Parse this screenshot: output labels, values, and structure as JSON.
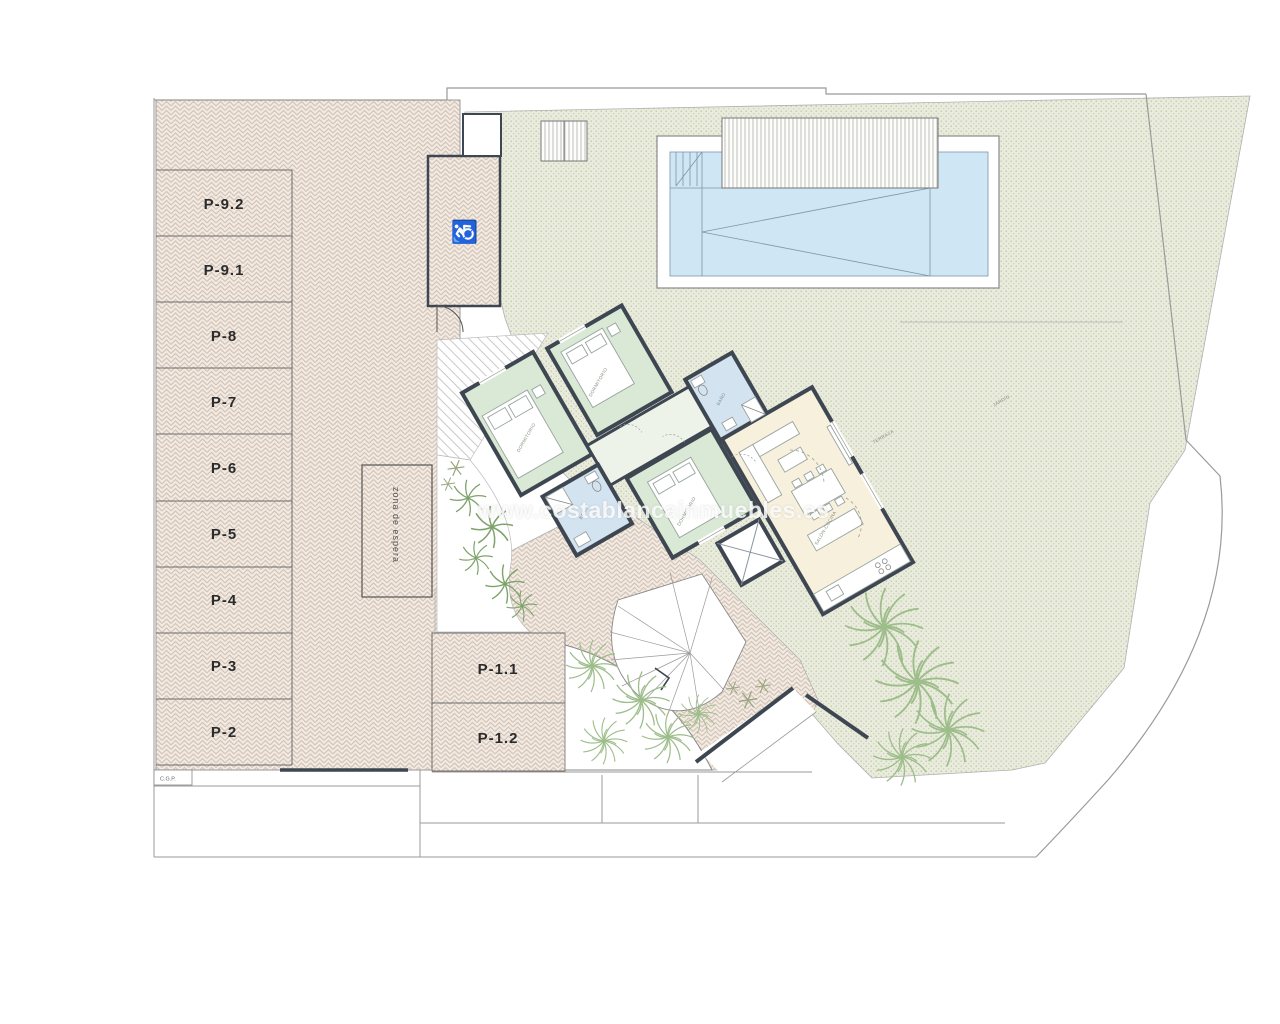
{
  "watermark": "www.costablancainmuebles.es",
  "parking": {
    "stalls": [
      "P-9.2",
      "P-9.1",
      "P-8",
      "P-7",
      "P-6",
      "P-5",
      "P-4",
      "P-3",
      "P-2"
    ],
    "front_stalls": [
      "P-1.1",
      "P-1.2"
    ],
    "waiting_zone": "zona de espera",
    "corner_label": "C.G.P.",
    "accessible_icon": "♿"
  },
  "house": {
    "room_labels": {
      "bedroom": "DORMITORIO",
      "bath": "BAÑO",
      "living": "SALÓN-COCINA",
      "terrace": "TERRAZA",
      "garden": "JARDÍN"
    }
  },
  "colors": {
    "walls": "#3e4751",
    "bedroom": "#d9e9d5",
    "bathroom": "#d4e3f0",
    "living": "#f6f0dd",
    "hall": "#eef3e9",
    "pool_water": "#cfe6f5",
    "paving_lines": "#d5c3b5",
    "garden_bg": "#e9ebdc",
    "plants": "#8fb77e"
  }
}
